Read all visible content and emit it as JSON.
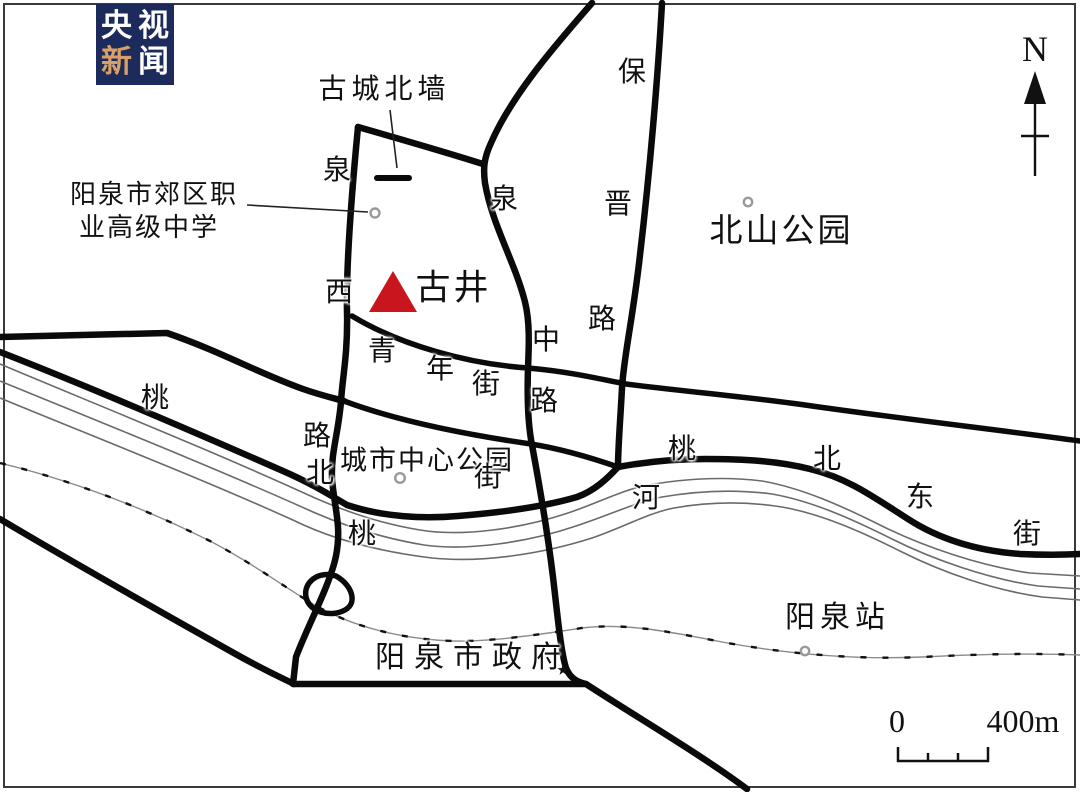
{
  "logo": {
    "name": "央视新闻",
    "chars": [
      "央",
      "视",
      "新",
      "闻"
    ],
    "highlight_char_index": 2,
    "bg_color": "#1d2b5c",
    "text_color": "#ffffff",
    "highlight_color": "#d7a066"
  },
  "colors": {
    "road": "#0a0a0a",
    "river": "#6a6a6a",
    "railway": "#8a8a8a",
    "frame": "#3a3a3a",
    "marker_red": "#c9151e",
    "marker_ring": "#9a9a9a",
    "text": "#111111"
  },
  "compass": {
    "label": "N"
  },
  "scale_bar": {
    "start": "0",
    "end": "400m"
  },
  "legend": {
    "landmark": {
      "name": "古井",
      "marker": "red-triangle"
    },
    "roads": [
      "泉西路",
      "泉中路",
      "保晋路",
      "青年街",
      "桃北东街"
    ],
    "river": "桃河",
    "wall": "古城北墙",
    "places": [
      "阳泉市郊区职业高级中学",
      "北山公园",
      "城市中心公园",
      "阳泉市政府",
      "阳泉站"
    ]
  },
  "map": {
    "labels": [
      {
        "t": "古城北墙",
        "x": 382,
        "y": 90,
        "s": 28,
        "ls": 5
      },
      {
        "t": "阳泉市郊区职",
        "x": 153,
        "y": 195,
        "s": 26,
        "ls": 2
      },
      {
        "t": "业高级中学",
        "x": 148,
        "y": 228,
        "s": 26,
        "ls": 2
      },
      {
        "t": "泉",
        "x": 337,
        "y": 171,
        "s": 28,
        "ls": 0
      },
      {
        "t": "西",
        "x": 339,
        "y": 293,
        "s": 28,
        "ls": 0
      },
      {
        "t": "路",
        "x": 317,
        "y": 437,
        "s": 28,
        "ls": 0
      },
      {
        "t": "泉",
        "x": 504,
        "y": 200,
        "s": 28,
        "ls": 0
      },
      {
        "t": "中",
        "x": 546,
        "y": 341,
        "s": 28,
        "ls": 0
      },
      {
        "t": "路",
        "x": 544,
        "y": 402,
        "s": 28,
        "ls": 0
      },
      {
        "t": "保",
        "x": 632,
        "y": 73,
        "s": 28,
        "ls": 0
      },
      {
        "t": "晋",
        "x": 618,
        "y": 205,
        "s": 28,
        "ls": 0
      },
      {
        "t": "路",
        "x": 602,
        "y": 320,
        "s": 28,
        "ls": 0
      },
      {
        "t": "北山公园",
        "x": 780,
        "y": 232,
        "s": 33,
        "ls": 3
      },
      {
        "t": "古井",
        "x": 452,
        "y": 288,
        "s": 35,
        "ls": 3
      },
      {
        "t": "青",
        "x": 382,
        "y": 352,
        "s": 28,
        "ls": 0
      },
      {
        "t": "年",
        "x": 440,
        "y": 370,
        "s": 28,
        "ls": 0
      },
      {
        "t": "街",
        "x": 486,
        "y": 385,
        "s": 28,
        "ls": 0
      },
      {
        "t": "城市中心公园",
        "x": 426,
        "y": 461,
        "s": 27,
        "ls": 2
      },
      {
        "t": "街",
        "x": 488,
        "y": 478,
        "s": 28,
        "ls": 0
      },
      {
        "t": "北",
        "x": 320,
        "y": 474,
        "s": 28,
        "ls": 0
      },
      {
        "t": "桃",
        "x": 155,
        "y": 399,
        "s": 28,
        "ls": 0
      },
      {
        "t": "桃",
        "x": 362,
        "y": 535,
        "s": 28,
        "ls": 0
      },
      {
        "t": "河",
        "x": 646,
        "y": 499,
        "s": 28,
        "ls": 0
      },
      {
        "t": "桃",
        "x": 682,
        "y": 450,
        "s": 28,
        "ls": 0
      },
      {
        "t": "北",
        "x": 827,
        "y": 460,
        "s": 28,
        "ls": 0
      },
      {
        "t": "东",
        "x": 920,
        "y": 498,
        "s": 28,
        "ls": 0
      },
      {
        "t": "街",
        "x": 1027,
        "y": 535,
        "s": 28,
        "ls": 0
      },
      {
        "t": "阳泉站",
        "x": 835,
        "y": 618,
        "s": 30,
        "ls": 5
      },
      {
        "t": "阳泉市政府",
        "x": 468,
        "y": 658,
        "s": 30,
        "ls": 9
      },
      {
        "t": "N",
        "x": 1035,
        "y": 49,
        "s": 36,
        "ls": 0
      },
      {
        "t": "0",
        "x": 897,
        "y": 721,
        "s": 32,
        "ls": 0
      },
      {
        "t": "400m",
        "x": 1023,
        "y": 721,
        "s": 32,
        "ls": 0
      }
    ]
  }
}
